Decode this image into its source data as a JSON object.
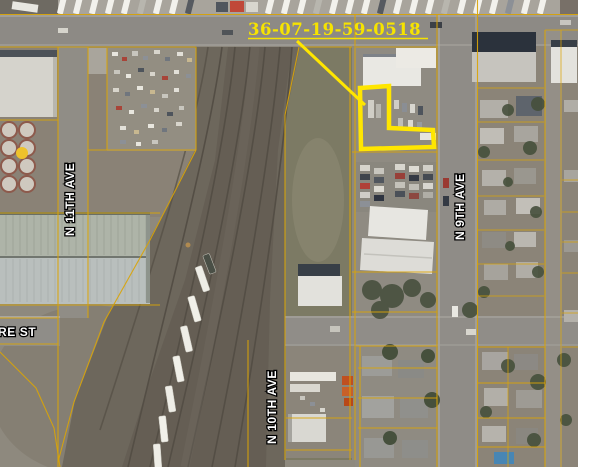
{
  "map": {
    "parcel_id": "36-07-19-59-0518",
    "streets": [
      {
        "name": "N 11TH AVE"
      },
      {
        "name": "N 9TH AVE"
      },
      {
        "name": "N 10TH AVE"
      },
      {
        "name": "RE ST"
      }
    ]
  },
  "colors": {
    "highlight_yellow": "#ffe600",
    "parcel_line": "#d9a408",
    "label_text": "#f6e300",
    "street_fill": "#ffffff",
    "street_outline": "#000000"
  }
}
